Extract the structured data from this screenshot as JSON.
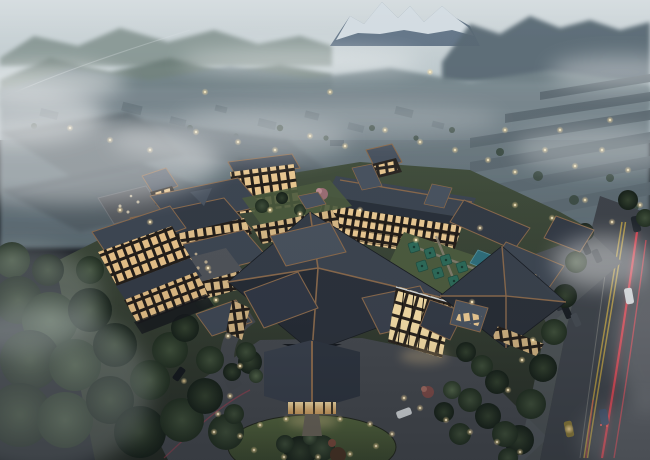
{
  "meta": {
    "title": "Aerial dusk architectural rendering of a mountain resort hotel complex",
    "description": "Bird's-eye rendering at dusk: a resort hotel with dark layered hip roofs and warmly lit balconies around garden courtyards, a porte-cochere entrance with an oval lawn island, dense forest at lower left, a misty village and warehouse blocks behind, snow-capped peaks on the horizon, and an avenue with red tail-light trails on the right.",
    "visible_text": "none"
  },
  "palette": {
    "sky_top": "#d6dde0",
    "sky_horizon": "#a8b7be",
    "hills_far": "#83938f",
    "hills_near": "#6d7e79",
    "mountain_dark": "#5a6b75",
    "mountain_rock": "#66788a",
    "snow": "#e8eef2",
    "mist": "#ffffff",
    "town_light": "#7d8b92",
    "town_dark": "#5f6e76",
    "village_roof": "#5d6a72",
    "warehouse_a": "#5a666d",
    "warehouse_b": "#616d74",
    "warehouse_c": "#525e66",
    "ground": "#3a4438",
    "roof_dark": "#343b46",
    "roof_mid": "#3e4753",
    "roof_light": "#4a5461",
    "ridge_copper": "#8a6a4d",
    "window_warm": "#ecca92",
    "glass_bright": "#f5dda6",
    "lawn": "#4d5c3f",
    "lawn_dark": "#33402b",
    "tree_dark": "#1f2b21",
    "tree_mid": "#2d3c2e",
    "tree_light": "#42543f",
    "asphalt": "#45494f",
    "road_asphalt": "#3f444b",
    "sidewalk": "#54595e",
    "lane_yellow": "#b59a43",
    "taillight": "#e0404e",
    "light_glow": "#ffdf9e",
    "pool": "#2f6f7c",
    "umbrella": "#2e6b5a",
    "deck_warm": "#6b5f4c",
    "car_white": "#d3d7da",
    "car_blue": "#3a4b66",
    "car_dark": "#15191e",
    "blossom_pink": "#9d6f76"
  },
  "scene": {
    "sky": {
      "label": "hazy dusk sky with fog banks"
    },
    "mountains": {
      "label": "snow-capped peak flanked by forested ridges"
    },
    "village": {
      "label": "misty town with rows of roofs and scattered warm lights"
    },
    "warehouses": {
      "label": "large flat-roofed blocks shrouded in fog, mid-left"
    },
    "resort": {
      "label": "resort hotel complex",
      "features": [
        "central lobby under a large faceted hip roof with copper ridges",
        "gabled porte-cochere entrance with glowing doorway",
        "glass atrium with warm interior light",
        "guest-room wings with grids of lit balconies",
        "corner tower pavilions",
        "garden courtyard with green canopies and a small pool",
        "roof terraces with tables"
      ]
    },
    "foreground": {
      "label": "arrival court and surroundings",
      "features": [
        "oval lawn island ringed by a driveway with path lights",
        "dense dark forest at lower left",
        "avenue on the right with double yellow line, cars and red tail-light trails",
        "row of parked cars beside the east pavilion"
      ]
    }
  }
}
